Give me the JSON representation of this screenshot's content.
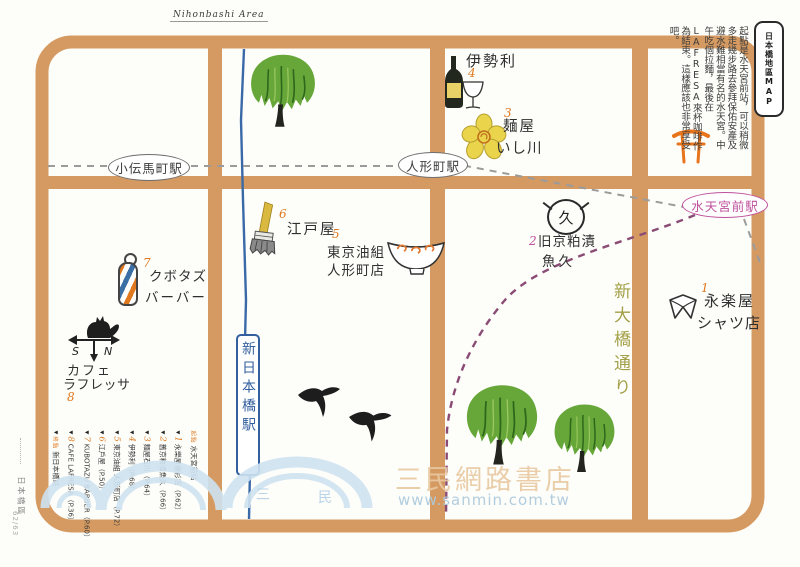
{
  "page": {
    "header_script": "Nihonbashi Area",
    "side_tab": "日本橋區",
    "page_number": "62/63"
  },
  "title_box": "日本橋地區MAP",
  "intro": "起點是水天宮前站，可以稍微多走幾步路去參拜保佑安產及避水難相當有名的水天宮。中午吃個拉麵，最後在LAFRESA來杯咖啡作為結束。這樣應該也非常享受吧。",
  "stations": {
    "kodenmacho": "小伝馬町駅",
    "ningyocho": "人形町駅",
    "suitengumae": "水天宮前駅",
    "shin_nihombashi": "新日本橋駅"
  },
  "street": {
    "shin_ohashi_dori": "新大橋通り"
  },
  "spots": [
    {
      "num": "1",
      "name": "永楽屋",
      "name2": "シャツ店",
      "icon": "shirt-collar-icon"
    },
    {
      "num": "2",
      "name": "旧京粕漬",
      "name2": "魚久",
      "icon": "uokyu-logo-icon",
      "logo_char": "久"
    },
    {
      "num": "3",
      "name": "麺屋",
      "name2": "いし川",
      "icon": "flower-icon"
    },
    {
      "num": "4",
      "name": "伊勢利",
      "name2": "",
      "icon": "wine-bottle-icon"
    },
    {
      "num": "5",
      "name": "東京油組",
      "name2": "人形町店",
      "icon": "bowl-icon"
    },
    {
      "num": "6",
      "name": "江戸屋",
      "name2": "",
      "icon": "brush-icon"
    },
    {
      "num": "7",
      "name": "クボタズ",
      "name2": "バーバー",
      "icon": "barber-pole-icon"
    },
    {
      "num": "8",
      "name": "カフェ",
      "name2": "ラフレッサ",
      "icon": "weathervane-icon"
    }
  ],
  "weathervane_letters": {
    "west": "S",
    "east": "N"
  },
  "legend": {
    "start_label": "起點",
    "start_station": "水天宮前站",
    "end_label": "終點",
    "end_station": "新日本橋站",
    "items": [
      {
        "num": "1",
        "text": "永樂屋襯衫店（P.62）"
      },
      {
        "num": "2",
        "text": "舊京粕漬魚久（P.66）"
      },
      {
        "num": "3",
        "text": "麵屋石川（P.64）"
      },
      {
        "num": "4",
        "text": "伊勢利（P.68）"
      },
      {
        "num": "5",
        "text": "東京油組 人形町店（P.72）"
      },
      {
        "num": "6",
        "text": "江戶屋（P.50）"
      },
      {
        "num": "7",
        "text": "KUBOTAZU BARBER（P.60）"
      },
      {
        "num": "8",
        "text": "CAFE LAFRESA（P.36）"
      }
    ]
  },
  "watermark": {
    "text": "三民網路書店",
    "url": "www.sanmin.com.tw",
    "logo_chars": [
      "三",
      "民"
    ]
  },
  "colors": {
    "road_tan": "#d59a61",
    "accent_orange": "#e0791f",
    "station_pink": "#bf519b",
    "railway_blue": "#3a69a8",
    "tree_green": "#67a73a",
    "street_olive": "#a3a047",
    "route_purple": "#8a4b74",
    "metro_gray": "#9b9b9b"
  }
}
